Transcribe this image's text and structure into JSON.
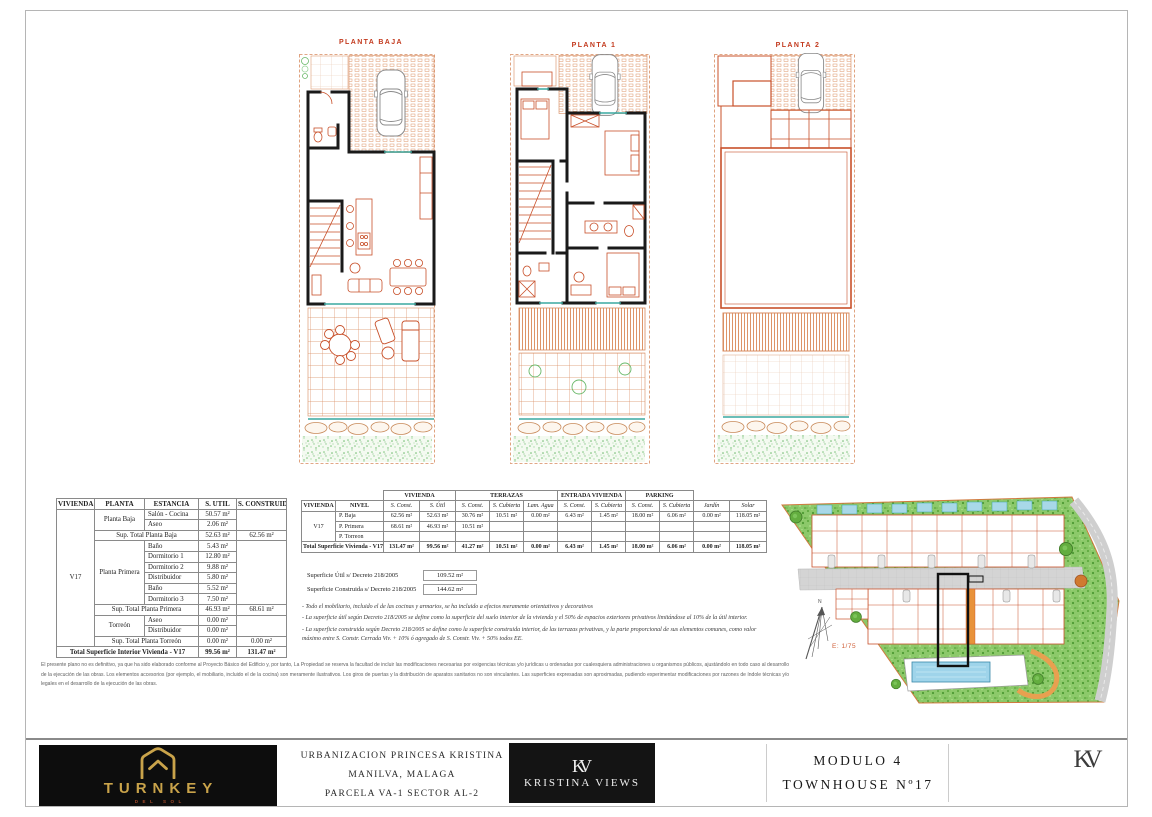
{
  "colors": {
    "plan_orange": "#c8502a",
    "wall_black": "#1a1a1a",
    "teal": "#3aa8a0",
    "title_red": "#c33a1e",
    "gold": "#c9a34a",
    "grass_green": "#8cc96a"
  },
  "plans": [
    {
      "title": "PLANTA BAJA"
    },
    {
      "title": "PLANTA 1"
    },
    {
      "title": "PLANTA 2"
    }
  ],
  "interior_table": {
    "headers": [
      "VIVIENDA",
      "PLANTA",
      "ESTANCIA",
      "S. UTIL",
      "S. CONSTRUIDA"
    ],
    "vivienda": "V17",
    "planta_baja": {
      "label": "Planta Baja",
      "rooms": [
        {
          "estancia": "Salón - Cocina",
          "util": "50.57 m²"
        },
        {
          "estancia": "Aseo",
          "util": "2.06 m²"
        }
      ],
      "subtotal": {
        "label": "Sup. Total Planta Baja",
        "util": "52.63 m²",
        "construida": "62.56 m²"
      }
    },
    "planta_primera": {
      "label": "Planta Primera",
      "rooms": [
        {
          "estancia": "Baño",
          "util": "5.43 m²"
        },
        {
          "estancia": "Dormitorio 1",
          "util": "12.80 m²"
        },
        {
          "estancia": "Dormitorio 2",
          "util": "9.88 m²"
        },
        {
          "estancia": "Distribuidor",
          "util": "5.80 m²"
        },
        {
          "estancia": "Baño",
          "util": "5.52 m²"
        },
        {
          "estancia": "Dormitorio 3",
          "util": "7.50 m²"
        }
      ],
      "subtotal": {
        "label": "Sup. Total Planta Primera",
        "util": "46.93 m²",
        "construida": "68.61 m²"
      }
    },
    "torreon": {
      "label": "Torreón",
      "rooms": [
        {
          "estancia": "Aseo",
          "util": "0.00 m²"
        },
        {
          "estancia": "Distribuidor",
          "util": "0.00 m²"
        }
      ],
      "subtotal": {
        "label": "Sup. Total Planta Torreón",
        "util": "0.00 m²",
        "construida": "0.00 m²"
      }
    },
    "total": {
      "label": "Total Superficie Interior Vivienda - V17",
      "util": "99.56 m²",
      "construida": "131.47 m²"
    }
  },
  "exterior_table": {
    "group_headers": {
      "vivienda": "VIVIENDA",
      "terrazas": "TERRAZAS",
      "entrada": "ENTRADA VIVIENDA",
      "parking": "PARKING"
    },
    "col_headers": [
      "VIVIENDA",
      "NIVEL",
      "S. Const.",
      "S. Útil",
      "S. Const.",
      "S. Cubierta",
      "Lam. Agua",
      "S. Const.",
      "S. Cubierta",
      "S. Const.",
      "S. Cubierta",
      "Jardín",
      "Solar"
    ],
    "vivienda": "V17",
    "rows": [
      {
        "nivel": "P. Baja",
        "v": [
          "62.56 m²",
          "52.63 m²",
          "30.76 m²",
          "10.51 m²",
          "0.00 m²",
          "6.43 m²",
          "1.45 m²",
          "18.00 m²",
          "6.06 m²",
          "0.00 m²",
          "118.05 m²"
        ]
      },
      {
        "nivel": "P. Primera",
        "v": [
          "68.61 m²",
          "46.93 m²",
          "10.51 m²",
          "",
          "",
          "",
          "",
          "",
          "",
          "",
          ""
        ]
      },
      {
        "nivel": "P. Torreon",
        "v": [
          "",
          "",
          "",
          "",
          "",
          "",
          "",
          "",
          "",
          "",
          ""
        ]
      }
    ],
    "total": {
      "label": "Total Superficie Vivienda - V17",
      "v": [
        "131.47 m²",
        "99.56 m²",
        "41.27 m²",
        "10.51 m²",
        "0.00 m²",
        "6.43 m²",
        "1.45 m²",
        "18.00 m²",
        "6.06 m²",
        "0.00 m²",
        "118.05 m²"
      ]
    }
  },
  "summary": {
    "util_label": "Superficie Útil s/ Decreto 218/2005",
    "util_value": "109.52 m²",
    "construida_label": "Superficie Construida s/ Decreto 218/2005",
    "construida_value": "144.62 m²"
  },
  "notes": [
    "- Todo el mobiliario, incluido el de las cocinas y armarios, se ha incluido a efectos meramente orientativos y decorativos",
    "- La superficie útil según Decreto 218/2005 se define como la superficie del suelo interior de la vivienda y el 50% de espacios exteriores privativos limitándose al 10% de la útil interior.",
    "- La superficie construida según Decreto 218/2005 se define como la superficie construida interior, de las terrazas privativas, y la parte proporcional de sus elementos comunes, como valor máximo entre S. Constr. Cerrada Viv. + 10% ó agregado de S. Constr. Viv. + 50% todos EE."
  ],
  "disclaimer": "El presente plano no es definitivo, ya que ha sido elaborado conforme al Proyecto Básico del Edificio y, por tanto, La Propiedad se reserva la facultad de incluir las modificaciones necesarias por exigencias técnicas y/o jurídicas u ordenadas por cualesquiera administraciones u organismos públicos, ajustándolo en todo caso al desarrollo de la ejecución de las obras. Los elementos accesorios (por ejemplo, el mobiliario, incluido el de la cocina) son meramente ilustrativos. Los giros de puertas y la distribución de aparatos sanitarios no son vinculantes. Las superficies expresadas son aproximadas, pudiendo experimentar modificaciones por razones de índole técnicas y/o legales en el desarrollo de la ejecución de las obras.",
  "site": {
    "scale_label": "E: 1/75",
    "north_label": "N"
  },
  "title_block": {
    "turnkey_name": "TURNKEY",
    "turnkey_sub": "DEL SOL",
    "project_lines": [
      "URBANIZACION PRINCESA KRISTINA",
      "MANILVA, MALAGA",
      "PARCELA VA-1 SECTOR AL-2"
    ],
    "kv_monogram": "KV",
    "kv_name": "KRISTINA VIEWS",
    "module_line1": "MODULO 4",
    "module_line2": "TOWNHOUSE Nº17"
  }
}
